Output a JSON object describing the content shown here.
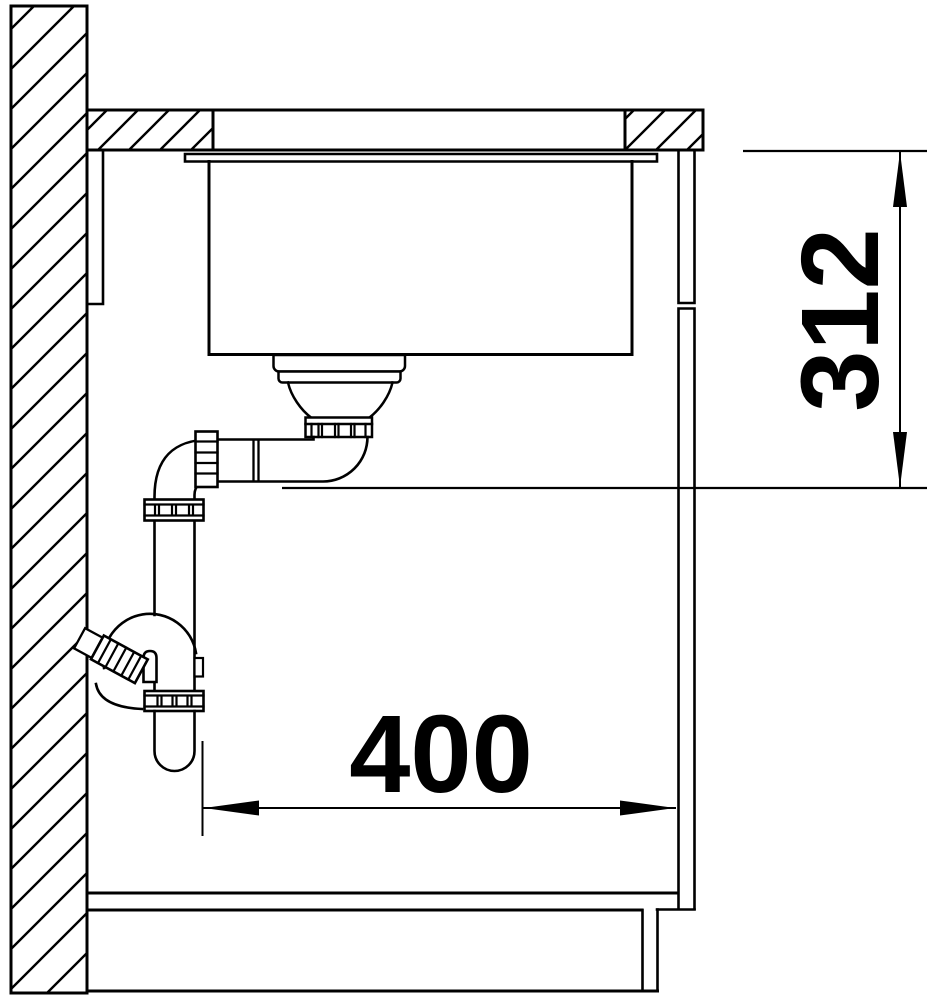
{
  "drawing": {
    "title": "Sink installation section drawing",
    "dimensions": {
      "vertical": {
        "label": "312"
      },
      "horizontal": {
        "label": "400"
      }
    }
  },
  "colors": {
    "line": "#000000",
    "background": "#ffffff"
  }
}
